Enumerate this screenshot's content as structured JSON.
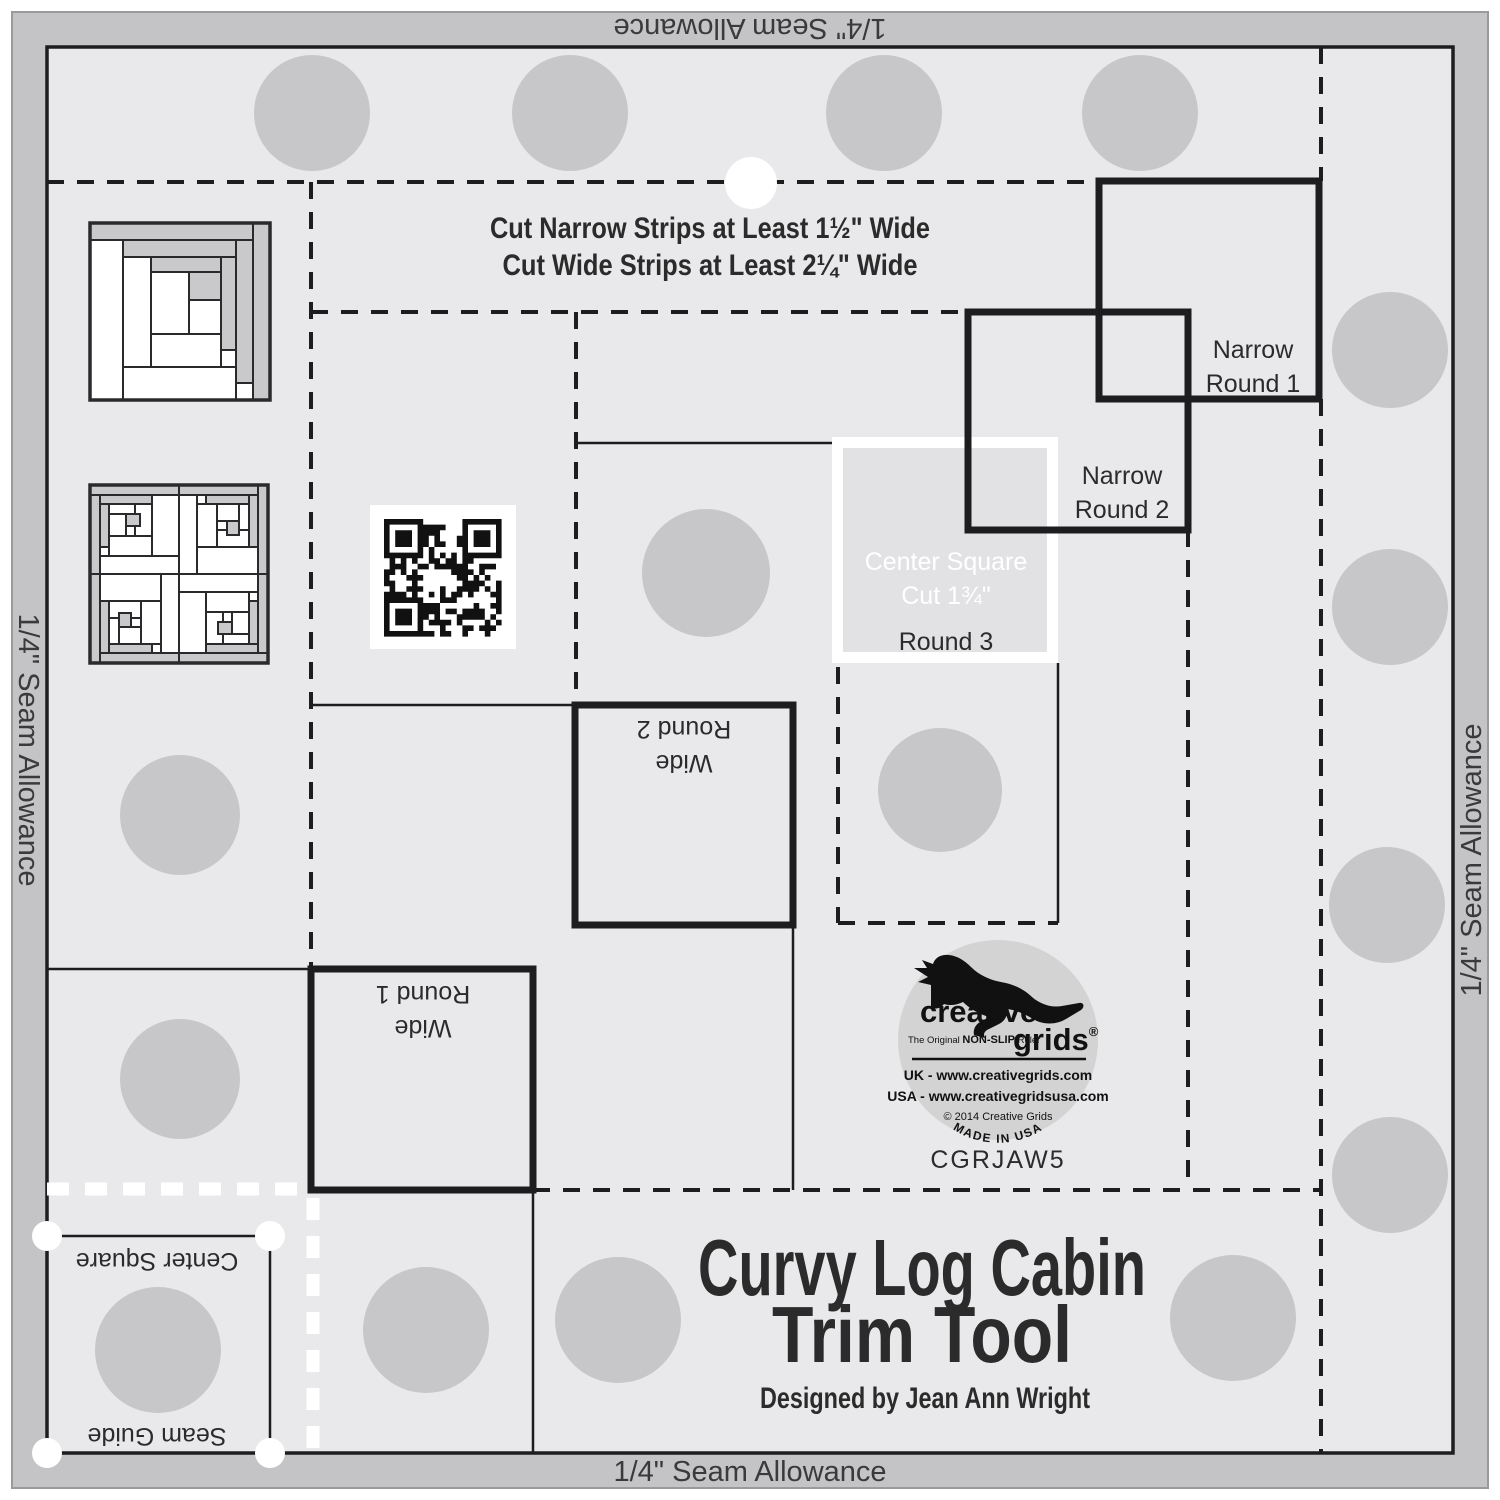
{
  "ruler": {
    "seam_allowance_label": "1/4\" Seam Allowance",
    "instructions": {
      "line1": "Cut Narrow Strips at Least 1½\" Wide",
      "line2": "Cut Wide Strips at Least 2¼\" Wide"
    },
    "regions": {
      "narrow_round_1": {
        "line1": "Narrow",
        "line2": "Round 1"
      },
      "narrow_round_2": {
        "line1": "Narrow",
        "line2": "Round 2"
      },
      "center_square": {
        "line1": "Center Square",
        "line2": "Cut 1¾\"",
        "line3": "Round 3"
      },
      "wide_round_2": {
        "line1": "Wide",
        "line2": "Round 2"
      },
      "wide_round_1": {
        "line1": "Wide",
        "line2": "Round 1"
      },
      "seam_guide_area": {
        "center_square_label": "Center Square",
        "seam_guide_label": "Seam Guide"
      }
    },
    "title": {
      "line1": "Curvy Log Cabin",
      "line2": "Trim Tool",
      "designer": "Designed by Jean Ann Wright"
    },
    "sku": "CGRJAW5",
    "logo": {
      "brand_line1": "creative.",
      "brand_line2": "grids",
      "registered": "®",
      "tagline_prefix": "The Original ",
      "tagline_bold": "NON-SLIP",
      "tagline_suffix": " Ruler",
      "uk_line": "UK - www.creativegrids.com",
      "usa_line": "USA - www.creativegridsusa.com",
      "copyright": "© 2014  Creative Grids",
      "made_in": "MADE IN USA"
    },
    "colors": {
      "band_gray": "#c4c4c6",
      "field_gray": "#e9e9eb",
      "grip_dot_gray": "#c7c7c9",
      "line_black": "#1d1d1f",
      "logo_fill": "#d3d3d4",
      "center_square_fill": "#e2e2e4"
    }
  }
}
